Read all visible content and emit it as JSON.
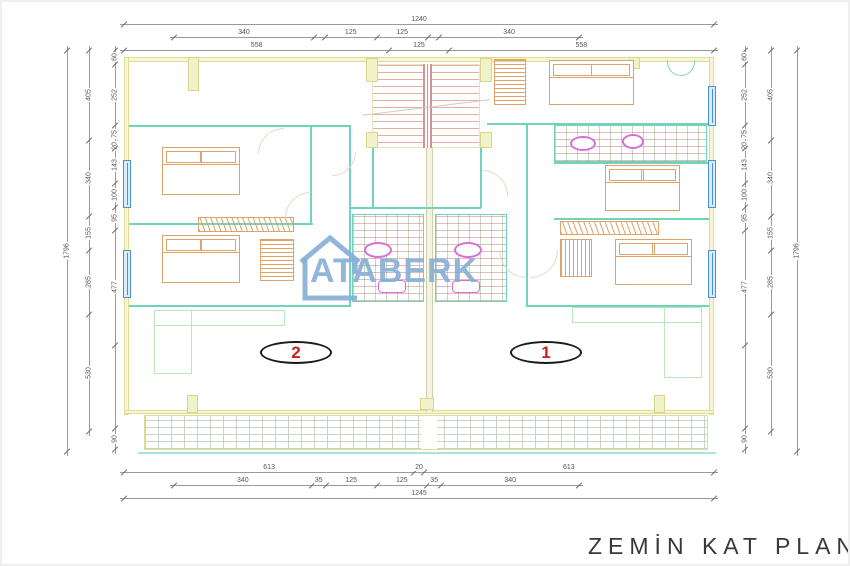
{
  "title": "ZEMİN KAT PLANI",
  "watermark": "ATABERK",
  "units": {
    "left": "2",
    "right": "1"
  },
  "colors": {
    "wall_teal": "#6fd4bc",
    "wall_khaki_fill": "#f6f6d2",
    "wall_khaki_line": "#dedc96",
    "furniture_orange": "#dfa26b",
    "window_blue": "#4a90d9",
    "fixture_magenta": "#d86fd8",
    "stair_tread": "#e2b0a0",
    "pale_green": "#b9e8b9",
    "terrace_grid": "#c9d4c9",
    "watermark_blue": "#85aed6",
    "unit_number_red": "#cc1f1f",
    "dimension_text": "#555555",
    "title_text": "#383838"
  },
  "dimensions": {
    "chains": [
      {
        "id": "top-total",
        "side": "top",
        "x": 122,
        "y": 12,
        "length": 590,
        "segments": [
          {
            "label": "1240",
            "size": 1240
          }
        ]
      },
      {
        "id": "top-inner",
        "side": "top",
        "x": 172,
        "y": 25,
        "length": 405,
        "segments": [
          {
            "label": "340",
            "size": 340
          },
          {
            "label": "",
            "size": 27
          },
          {
            "label": "125",
            "size": 125
          },
          {
            "label": "125",
            "size": 125
          },
          {
            "label": "",
            "size": 27
          },
          {
            "label": "340",
            "size": 340
          }
        ]
      },
      {
        "id": "top-wall",
        "side": "top",
        "x": 122,
        "y": 38,
        "length": 590,
        "segments": [
          {
            "label": "558",
            "size": 558
          },
          {
            "label": "125",
            "size": 125
          },
          {
            "label": "558",
            "size": 558
          }
        ]
      },
      {
        "id": "bottom-wall",
        "side": "bottom",
        "x": 122,
        "y": 460,
        "length": 590,
        "segments": [
          {
            "label": "613",
            "size": 613
          },
          {
            "label": "20",
            "size": 20
          },
          {
            "label": "613",
            "size": 613
          }
        ]
      },
      {
        "id": "bottom-inner",
        "side": "bottom",
        "x": 172,
        "y": 473,
        "length": 405,
        "segments": [
          {
            "label": "340",
            "size": 340
          },
          {
            "label": "35",
            "size": 35
          },
          {
            "label": "125",
            "size": 125
          },
          {
            "label": "125",
            "size": 125
          },
          {
            "label": "35",
            "size": 35
          },
          {
            "label": "340",
            "size": 340
          }
        ]
      },
      {
        "id": "bottom-total",
        "side": "bottom",
        "x": 122,
        "y": 486,
        "length": 590,
        "segments": [
          {
            "label": "1245",
            "size": 1245
          }
        ]
      },
      {
        "id": "left-total",
        "side": "left",
        "x": 58,
        "y": 48,
        "length": 402,
        "segments": [
          {
            "label": "1796",
            "size": 1796
          }
        ]
      },
      {
        "id": "left-mid",
        "side": "left",
        "x": 80,
        "y": 48,
        "length": 382,
        "segments": [
          {
            "label": "405",
            "size": 405
          },
          {
            "label": "340",
            "size": 340
          },
          {
            "label": "155",
            "size": 155
          },
          {
            "label": "285",
            "size": 285
          },
          {
            "label": "530",
            "size": 530
          }
        ]
      },
      {
        "id": "left-inner",
        "side": "left",
        "x": 106,
        "y": 48,
        "length": 400,
        "segments": [
          {
            "label": "60",
            "size": 60
          },
          {
            "label": "252",
            "size": 252
          },
          {
            "label": "75",
            "size": 75
          },
          {
            "label": "20",
            "size": 20
          },
          {
            "label": "143",
            "size": 143
          },
          {
            "label": "100",
            "size": 100
          },
          {
            "label": "95",
            "size": 95
          },
          {
            "label": "477",
            "size": 477
          },
          {
            "label": "",
            "size": 346
          },
          {
            "label": "90",
            "size": 90
          }
        ]
      },
      {
        "id": "right-inner",
        "side": "right",
        "x": 736,
        "y": 48,
        "length": 400,
        "segments": [
          {
            "label": "60",
            "size": 60
          },
          {
            "label": "252",
            "size": 252
          },
          {
            "label": "75",
            "size": 75
          },
          {
            "label": "20",
            "size": 20
          },
          {
            "label": "143",
            "size": 143
          },
          {
            "label": "100",
            "size": 100
          },
          {
            "label": "95",
            "size": 95
          },
          {
            "label": "477",
            "size": 477
          },
          {
            "label": "",
            "size": 346
          },
          {
            "label": "90",
            "size": 90
          }
        ]
      },
      {
        "id": "right-mid",
        "side": "right",
        "x": 762,
        "y": 48,
        "length": 382,
        "segments": [
          {
            "label": "405",
            "size": 405
          },
          {
            "label": "340",
            "size": 340
          },
          {
            "label": "155",
            "size": 155
          },
          {
            "label": "285",
            "size": 285
          },
          {
            "label": "530",
            "size": 530
          }
        ]
      },
      {
        "id": "right-total",
        "side": "right",
        "x": 788,
        "y": 48,
        "length": 402,
        "segments": [
          {
            "label": "1796",
            "size": 1796
          }
        ]
      }
    ]
  }
}
